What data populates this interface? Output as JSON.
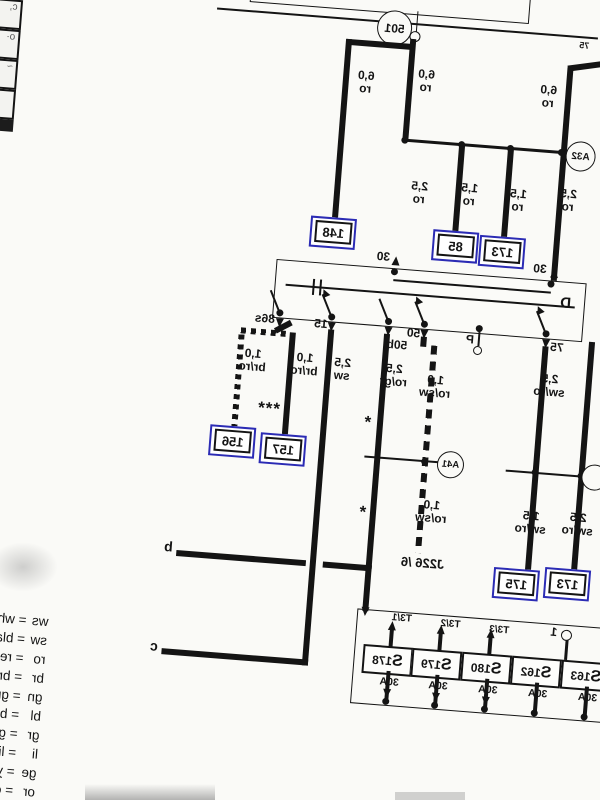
{
  "circles": {
    "c501": "501",
    "a32": "A32",
    "a41": "A41"
  },
  "wires": {
    "feed_left_top": "6,0\nro",
    "feed_left_mid": "2,5\nro",
    "main_top": "6,0\nro",
    "branch_148": "6,0\nro",
    "main_mid": "2,5\nro",
    "to_85": "1,5\nro",
    "to_173": "1,5\nro",
    "t75_upper": "2,5\nsw/ro",
    "t75_lower": "1,5\nsw/ro",
    "t30_lower": "2,5\nsw/ro",
    "rogr": "2,5\nro/gr",
    "rosw_upper": "1,0\nro/sw",
    "rosw_lower": "1,0\nro/sw",
    "sw": "2,5\nsw",
    "to_157": "1,0\nbr/ro",
    "to_156": "1,0\nbr/ro"
  },
  "switch": {
    "designation": "D",
    "t30_left": "30",
    "t30_right": "30",
    "t75": "75",
    "tP": "P",
    "t50": "50",
    "t50b": "50b",
    "t15": "15",
    "t86s": "86s"
  },
  "track_boxes": {
    "b148": "148",
    "b85": "85",
    "b173": "173",
    "b156": "156",
    "b157": "157",
    "b175": "175",
    "b173b": "173"
  },
  "misc": {
    "j226": "J226 /6",
    "cont_b": "b",
    "cont_c": "c",
    "stars3": "***",
    "star1": "*",
    "star2": "*",
    "small75": "75",
    "terminal1": "1"
  },
  "fuse_panel": {
    "fuses": [
      {
        "label": "S178",
        "amp": "30A"
      },
      {
        "label": "S179",
        "amp": "30A"
      },
      {
        "label": "S180",
        "amp": "30A"
      },
      {
        "label": "S162",
        "amp": "30A"
      },
      {
        "label": "S163",
        "amp": "30A"
      }
    ],
    "connectors": [
      "T3/1",
      "T3/2",
      "T3/3"
    ]
  },
  "legend": [
    {
      "code": "ws",
      "name": "white"
    },
    {
      "code": "sw",
      "name": "black"
    },
    {
      "code": "ro",
      "name": "red"
    },
    {
      "code": "br",
      "name": "brown"
    },
    {
      "code": "gn",
      "name": "green"
    },
    {
      "code": "bl",
      "name": "blue"
    },
    {
      "code": "gr",
      "name": "grey"
    },
    {
      "code": "li",
      "name": "lilac"
    },
    {
      "code": "ge",
      "name": "yellow"
    },
    {
      "code": "or",
      "name": "orange"
    }
  ]
}
